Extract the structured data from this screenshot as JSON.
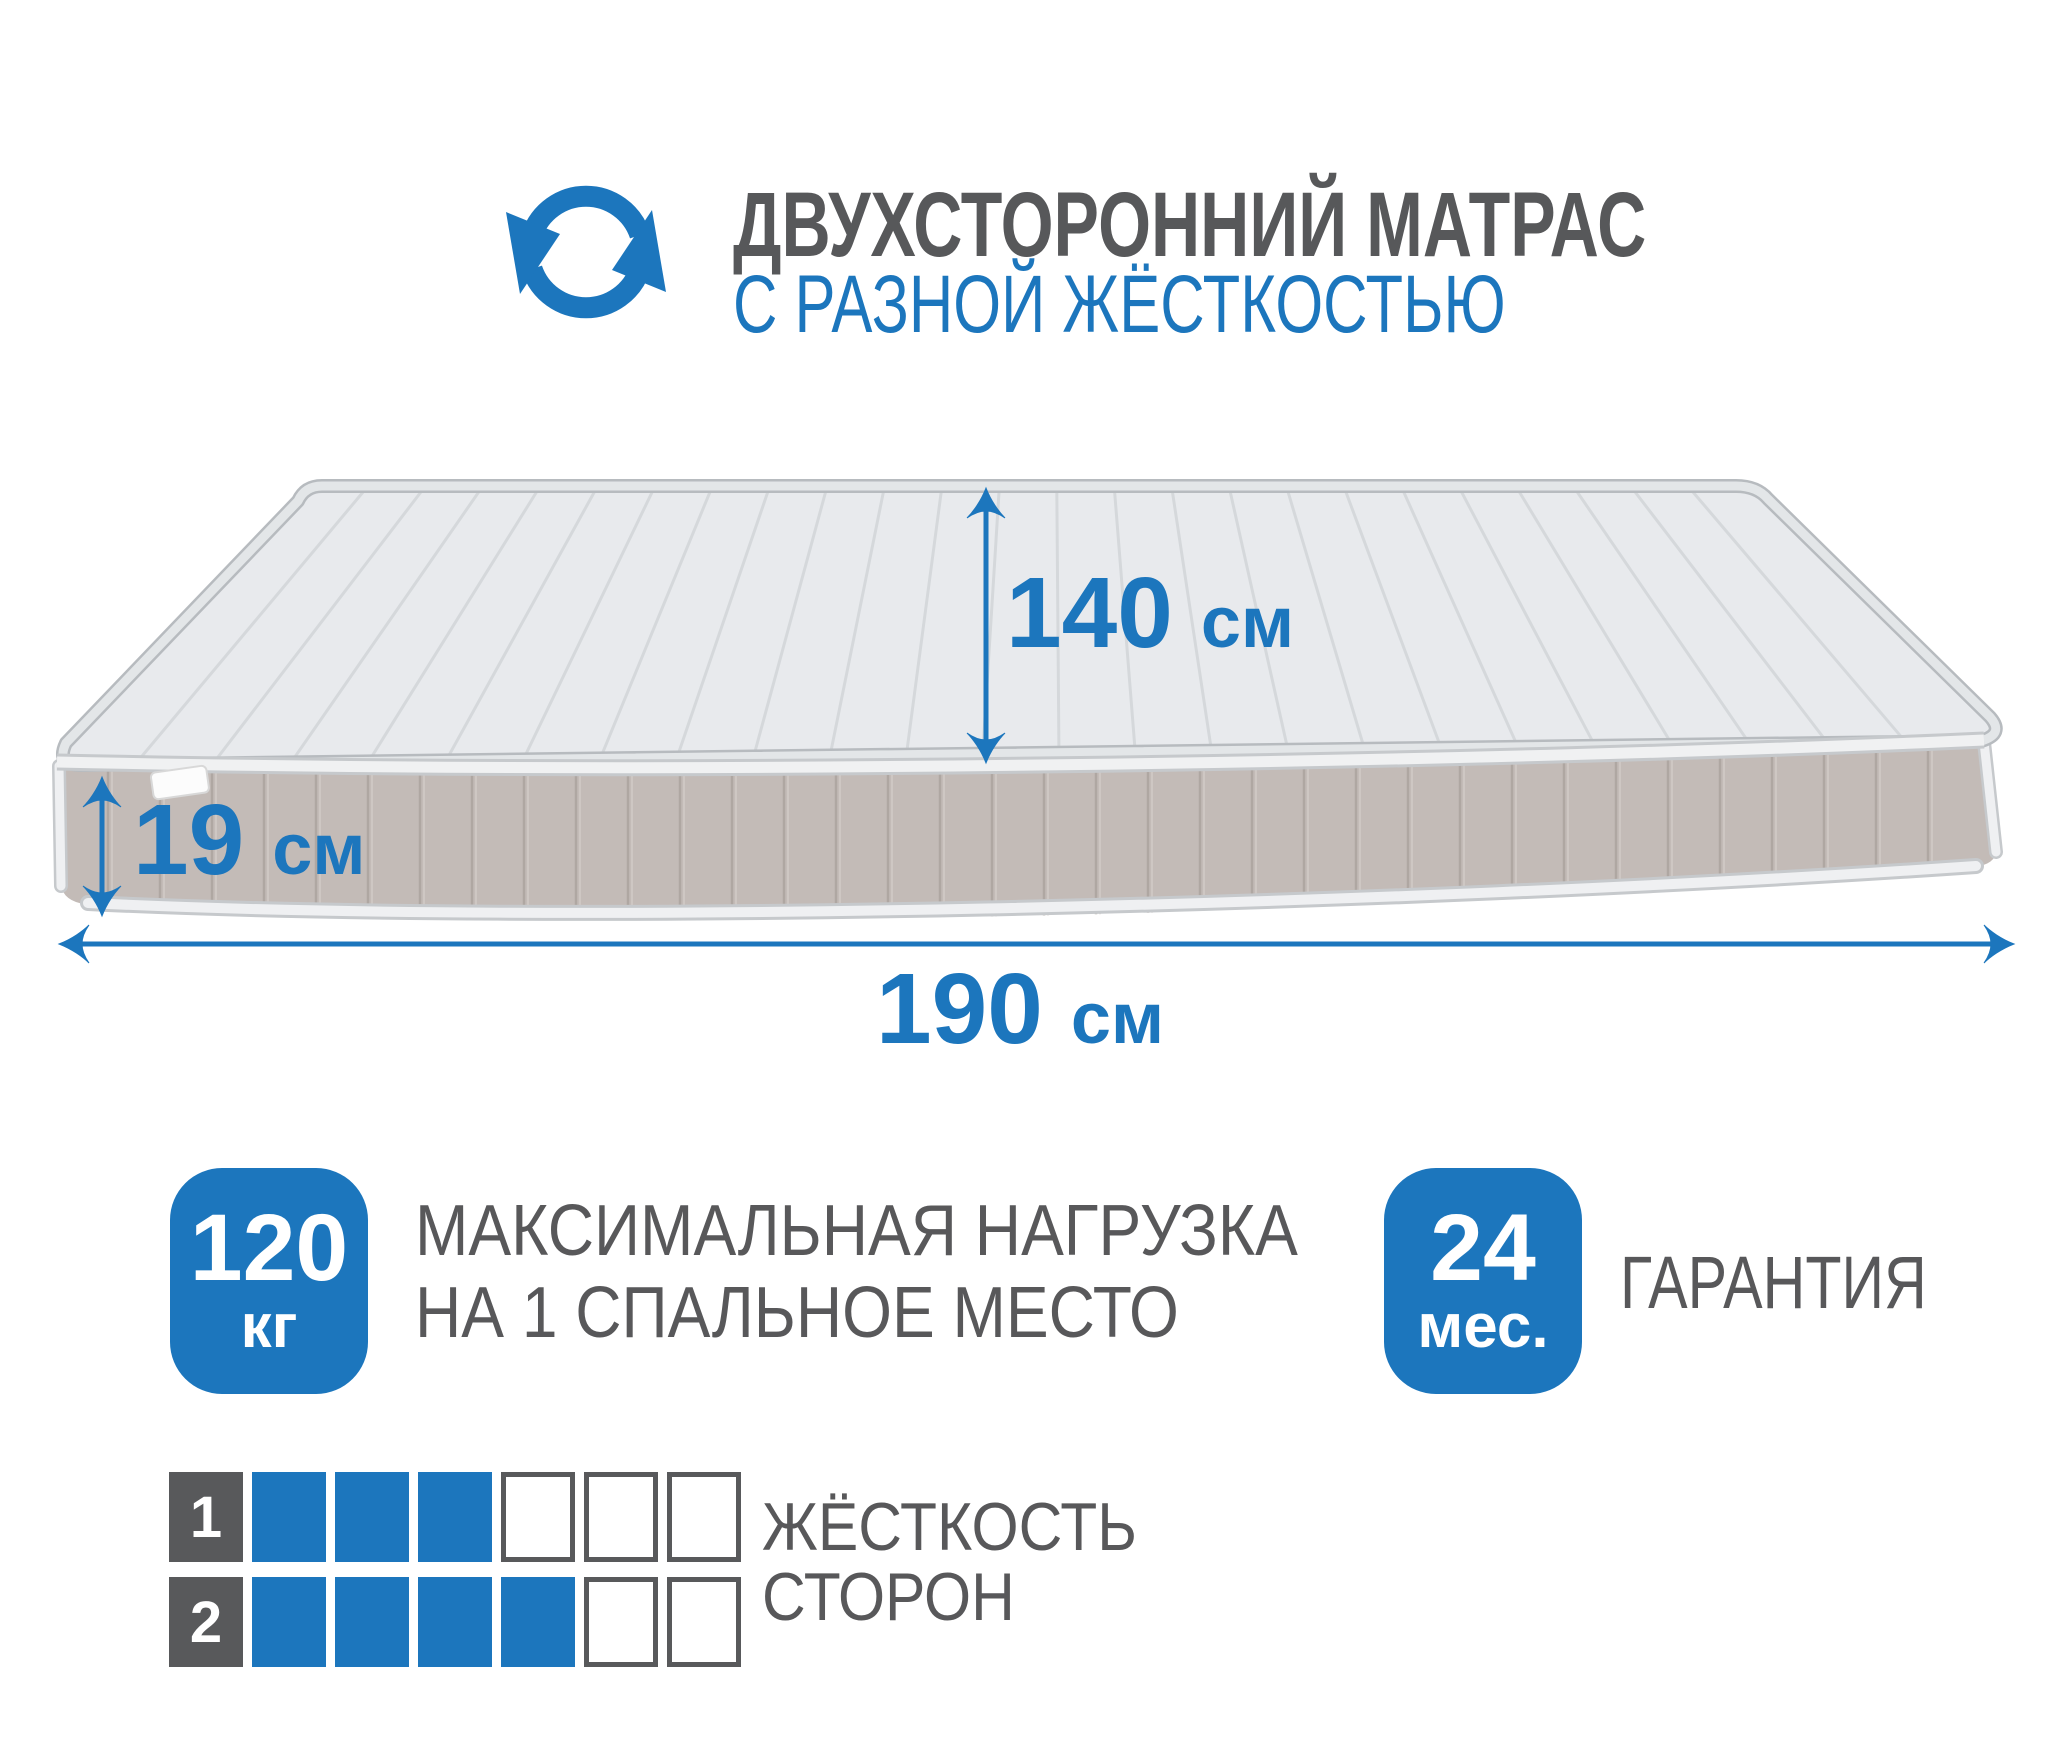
{
  "colors": {
    "accent_blue": "#1C76BD",
    "text_gray": "#58585A",
    "mattress_top": "#E8EAED",
    "mattress_side": "#C3BBB7",
    "piping": "#EFF0F2"
  },
  "header": {
    "icon": "rotate-arrows-icon",
    "title": "ДВУХСТОРОННИЙ МАТРАС",
    "subtitle": "С РАЗНОЙ ЖЁСТКОСТЬЮ"
  },
  "mattress": {
    "dimensions": {
      "width": {
        "value": "140",
        "unit": "см"
      },
      "height": {
        "value": "19",
        "unit": "см"
      },
      "length": {
        "value": "190",
        "unit": "см"
      }
    }
  },
  "badges": {
    "max_load": {
      "value": "120",
      "unit": "кг",
      "label_line1": "МАКСИМАЛЬНАЯ НАГРУЗКА",
      "label_line2": "НА 1 СПАЛЬНОЕ МЕСТО"
    },
    "warranty": {
      "value": "24",
      "unit": "мес.",
      "label": "ГАРАНТИЯ"
    }
  },
  "firmness": {
    "label_line1": "ЖЁСТКОСТЬ",
    "label_line2": "СТОРОН",
    "scale_max": 6,
    "sides": [
      {
        "side": "1",
        "value": 3
      },
      {
        "side": "2",
        "value": 4
      }
    ]
  }
}
